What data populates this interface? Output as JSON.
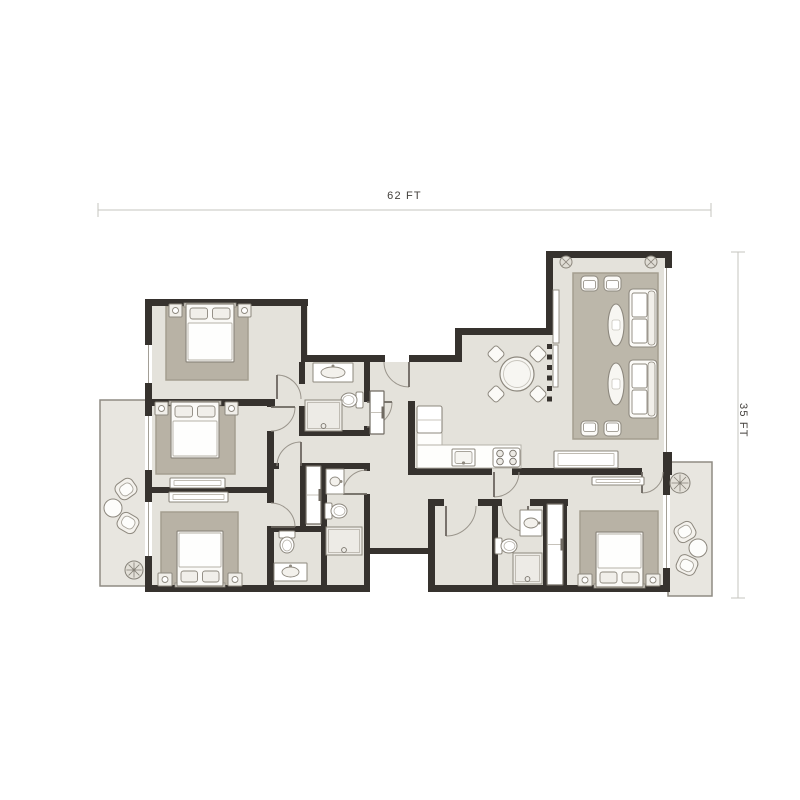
{
  "dimensions": {
    "width_label": "62 FT",
    "height_label": "35 FT",
    "top_line": {
      "x1": 98,
      "x2": 711,
      "y": 210
    },
    "right_line": {
      "x": 738,
      "y1": 252,
      "y2": 598
    }
  },
  "colors": {
    "wall": "#36322e",
    "floor": "#e4e2db",
    "balcony": "#e8e6e0",
    "balconyEdge": "#8f8b83",
    "rug": "#b8b2a5",
    "rugBorder": "#a49e90",
    "livingRug": "#bcb7aa",
    "line": "#8d887e",
    "furn": "#fbfaf7",
    "furnLight": "#f1efea",
    "white": "#ffffff",
    "shower": "#edebe6",
    "innerLine": "#b5b1a8",
    "windowLine": "#a39f96",
    "dimLine": "#c6c4bf",
    "arc": "#9a958c",
    "leaf": "#6b665f",
    "lightGray": "#dcd9d1",
    "dark": "#6f6a62"
  },
  "plan": {
    "balconies": [
      {
        "name": "balcony-left",
        "r": [
          100,
          400,
          48,
          186
        ]
      },
      {
        "name": "balcony-right",
        "r": [
          668,
          462,
          44,
          134
        ]
      }
    ],
    "floors": [
      {
        "name": "floor-bedrooms-left",
        "r": [
          148,
          302,
          160,
          283
        ]
      },
      {
        "name": "floor-corridor",
        "r": [
          305,
          362,
          123,
          192
        ]
      },
      {
        "name": "floor-bath-south",
        "r": [
          308,
          554,
          60,
          32
        ]
      },
      {
        "name": "floor-central",
        "r": [
          462,
          335,
          91,
          140
        ]
      },
      {
        "name": "floor-kitchen-dining",
        "r": [
          410,
          362,
          143,
          113
        ]
      },
      {
        "name": "floor-living-room",
        "r": [
          550,
          255,
          118,
          215
        ]
      },
      {
        "name": "floor-south-cluster",
        "r": [
          368,
          470,
          200,
          84
        ]
      },
      {
        "name": "floor-south-cluster-low",
        "r": [
          428,
          554,
          140,
          32
        ]
      },
      {
        "name": "floor-bedroom-4",
        "r": [
          560,
          470,
          108,
          116
        ]
      }
    ],
    "rugs": [
      {
        "name": "rug-bedroom-1",
        "r": [
          166,
          306,
          82,
          74
        ],
        "living": false
      },
      {
        "name": "rug-bedroom-2",
        "r": [
          156,
          406,
          79,
          68
        ],
        "living": false
      },
      {
        "name": "rug-bedroom-3",
        "r": [
          161,
          512,
          77,
          74
        ],
        "living": false
      },
      {
        "name": "rug-bedroom-4",
        "r": [
          580,
          511,
          78,
          76
        ],
        "living": false
      },
      {
        "name": "rug-living-room",
        "r": [
          573,
          273,
          85,
          166
        ],
        "living": true
      }
    ],
    "walls": [
      [
        145,
        299,
        163,
        7
      ],
      [
        301,
        355,
        84,
        7
      ],
      [
        409,
        355,
        53,
        7
      ],
      [
        455,
        328,
        98,
        7
      ],
      [
        546,
        251,
        126,
        7
      ],
      [
        145,
        399,
        130,
        7
      ],
      [
        145,
        487,
        129,
        6
      ],
      [
        145,
        585,
        225,
        7
      ],
      [
        299,
        430,
        71,
        6
      ],
      [
        267,
        463,
        12,
        6
      ],
      [
        301,
        463,
        69,
        6
      ],
      [
        267,
        526,
        59,
        6
      ],
      [
        368,
        548,
        67,
        6
      ],
      [
        428,
        499,
        16,
        7
      ],
      [
        478,
        499,
        24,
        7
      ],
      [
        530,
        499,
        38,
        7
      ],
      [
        408,
        468,
        84,
        7
      ],
      [
        512,
        468,
        130,
        7
      ],
      [
        663,
        468,
        9,
        7
      ],
      [
        560,
        585,
        110,
        7
      ],
      [
        428,
        585,
        139,
        7
      ],
      [
        145,
        299,
        7,
        46
      ],
      [
        145,
        383,
        7,
        24
      ],
      [
        145,
        406,
        7,
        10
      ],
      [
        145,
        470,
        7,
        32
      ],
      [
        145,
        556,
        7,
        36
      ],
      [
        301,
        299,
        6,
        63
      ],
      [
        455,
        328,
        7,
        34
      ],
      [
        546,
        251,
        7,
        84
      ],
      [
        665,
        251,
        7,
        17
      ],
      [
        663,
        452,
        9,
        23
      ],
      [
        408,
        401,
        7,
        74
      ],
      [
        299,
        362,
        6,
        22
      ],
      [
        299,
        406,
        6,
        30
      ],
      [
        364,
        355,
        6,
        47
      ],
      [
        364,
        426,
        6,
        10
      ],
      [
        267,
        399,
        7,
        8
      ],
      [
        267,
        431,
        7,
        56
      ],
      [
        267,
        487,
        7,
        16
      ],
      [
        267,
        527,
        7,
        65
      ],
      [
        300,
        463,
        6,
        63
      ],
      [
        321,
        463,
        6,
        122
      ],
      [
        364,
        463,
        6,
        8
      ],
      [
        364,
        494,
        6,
        96
      ],
      [
        428,
        499,
        7,
        93
      ],
      [
        492,
        499,
        6,
        93
      ],
      [
        543,
        499,
        4,
        90
      ],
      [
        563,
        499,
        4,
        90
      ],
      [
        663,
        475,
        7,
        20
      ],
      [
        663,
        568,
        7,
        24
      ]
    ],
    "windows": [
      [
        145,
        345,
        7,
        38
      ],
      [
        145,
        416,
        7,
        54
      ],
      [
        145,
        502,
        7,
        54
      ],
      [
        663,
        495,
        7,
        73
      ],
      [
        664,
        268,
        5,
        184
      ]
    ],
    "doors": [
      {
        "leaf": "M409 362 L409 387",
        "arc": "M409 387 A25 25 0 0 1 384 362"
      },
      {
        "leaf": "M367 402 L392 402",
        "arc": "M392 402 A25 25 0 0 1 367 427"
      },
      {
        "leaf": "M271 407 L295 407",
        "arc": "M295 407 A24 24 0 0 1 271 431"
      },
      {
        "leaf": "M271 527 L295 527",
        "arc": "M295 527 A24 24 0 0 0 271 503"
      },
      {
        "leaf": "M301 466 L301 442",
        "arc": "M301 442 A24 24 0 0 0 277 466"
      },
      {
        "leaf": "M494 472 L494 497",
        "arc": "M494 497 A25 25 0 0 0 519 472"
      },
      {
        "leaf": "M446 506 L446 536",
        "arc": "M446 536 A30 30 0 0 0 476 506"
      },
      {
        "leaf": "M528 506 L528 532",
        "arc": "M528 532 A26 26 0 0 1 502 506"
      },
      {
        "leaf": "M642 472 L642 493",
        "arc": "M642 493 A21 21 0 0 0 663 472"
      },
      {
        "leaf": "M367 494 L343 494",
        "arc": "M343 494 A24 24 0 0 1 367 470"
      },
      {
        "leaf": "M277 399 L277 375",
        "arc": "M277 375 A24 24 0 0 1 301 399"
      }
    ],
    "dash_partition": {
      "x": 547,
      "y0": 344,
      "count": 6,
      "size": 5,
      "gap": 5.5
    },
    "wall_shelves": [
      {
        "name": "tv-console",
        "r": [
          553,
          290,
          6,
          53
        ]
      },
      {
        "name": "wall-shelf",
        "r": [
          553,
          345,
          5,
          42
        ]
      }
    ],
    "beds": [
      {
        "name": "bed-bedroom-1",
        "x": 186,
        "y": 304,
        "w": 48,
        "h": 58,
        "head": "top"
      },
      {
        "name": "bed-bedroom-2",
        "x": 171,
        "y": 402,
        "w": 48,
        "h": 56,
        "head": "top"
      },
      {
        "name": "bed-bedroom-3",
        "x": 177,
        "y": 531,
        "w": 46,
        "h": 55,
        "head": "bottom"
      },
      {
        "name": "bed-bedroom-4",
        "x": 596,
        "y": 532,
        "w": 47,
        "h": 55,
        "head": "bottom"
      }
    ],
    "nightstands": [
      [
        169,
        304,
        13,
        13
      ],
      [
        238,
        304,
        13,
        13
      ],
      [
        155,
        402,
        13,
        13
      ],
      [
        225,
        402,
        13,
        13
      ],
      [
        158,
        573,
        14,
        13
      ],
      [
        228,
        573,
        14,
        13
      ],
      [
        578,
        574,
        14,
        12
      ],
      [
        646,
        574,
        14,
        12
      ]
    ],
    "dressers": [
      {
        "name": "dresser-bedroom-2",
        "r": [
          170,
          478,
          55,
          10
        ]
      },
      {
        "name": "dresser-bedroom-3",
        "r": [
          169,
          492,
          59,
          10
        ]
      },
      {
        "name": "console-bedroom-4",
        "r": [
          592,
          477,
          52,
          8
        ]
      },
      {
        "name": "sideboard-living",
        "r": [
          554,
          451,
          64,
          17
        ]
      }
    ],
    "wardrobes": [
      {
        "name": "wardrobe-corridor",
        "r": [
          370,
          391,
          14,
          43
        ]
      },
      {
        "name": "wardrobe-cluster",
        "r": [
          306,
          466,
          15,
          58
        ]
      },
      {
        "name": "closet-bedroom-4",
        "r": [
          547,
          504,
          16,
          81
        ]
      }
    ],
    "sofas": [
      {
        "name": "sofa-1",
        "r": [
          629,
          289,
          28,
          58
        ]
      },
      {
        "name": "sofa-2",
        "r": [
          629,
          360,
          28,
          58
        ]
      }
    ],
    "armchairs": [
      {
        "r": [
          581,
          276,
          17,
          15
        ],
        "face": "down"
      },
      {
        "r": [
          604,
          276,
          17,
          15
        ],
        "face": "down"
      },
      {
        "r": [
          581,
          421,
          17,
          15
        ],
        "face": "up"
      },
      {
        "r": [
          604,
          421,
          17,
          15
        ],
        "face": "up"
      }
    ],
    "oval_tables": [
      [
        616,
        325,
        8,
        21
      ],
      [
        616,
        384,
        8,
        21
      ]
    ],
    "ceiling_lights": [
      [
        566,
        262,
        6
      ],
      [
        651,
        262,
        6
      ]
    ],
    "dining": {
      "table": [
        517,
        374,
        17
      ],
      "chair_size": 13,
      "chairs": [
        [
          496,
          354
        ],
        [
          538,
          354
        ],
        [
          496,
          394
        ],
        [
          538,
          394
        ]
      ]
    },
    "kitchen": {
      "fridge": [
        417,
        406,
        25,
        27
      ],
      "counters": [
        [
          417,
          433,
          25,
          35
        ],
        [
          417,
          445,
          104,
          23
        ]
      ],
      "sink": [
        452,
        449,
        23,
        17
      ],
      "hob": [
        493,
        448,
        27,
        19
      ]
    },
    "vanities": [
      {
        "name": "vanity-bath-north",
        "r": [
          313,
          363,
          40,
          19
        ],
        "o": "h"
      },
      {
        "name": "vanity-bath-mid",
        "r": [
          326,
          469,
          18,
          25
        ],
        "o": "v"
      },
      {
        "name": "vanity-bath-maid",
        "r": [
          274,
          563,
          33,
          18
        ],
        "o": "h"
      },
      {
        "name": "vanity-bath-south",
        "r": [
          520,
          510,
          22,
          26
        ],
        "o": "v"
      }
    ],
    "toilets": [
      {
        "name": "toilet-bath-north",
        "c": [
          352,
          400
        ],
        "rot": -90
      },
      {
        "name": "toilet-bath-mid",
        "c": [
          336,
          511
        ],
        "rot": 90
      },
      {
        "name": "toilet-bath-maid",
        "c": [
          287,
          542
        ],
        "rot": 180
      },
      {
        "name": "toilet-bath-south",
        "c": [
          506,
          546
        ],
        "rot": 90
      }
    ],
    "showers": [
      {
        "name": "shower-bath-north",
        "r": [
          305,
          400,
          37,
          31
        ]
      },
      {
        "name": "shower-bath-mid",
        "r": [
          326,
          527,
          36,
          28
        ]
      },
      {
        "name": "shower-bath-south",
        "r": [
          513,
          553,
          29,
          31
        ]
      }
    ],
    "balcony_chairs": [
      {
        "c": [
          126,
          489
        ],
        "rot": -35
      },
      {
        "c": [
          128,
          523
        ],
        "rot": 210
      },
      {
        "c": [
          685,
          532
        ],
        "rot": 150
      },
      {
        "c": [
          687,
          565
        ],
        "rot": 25
      }
    ],
    "balcony_tables": [
      [
        113,
        508,
        9
      ],
      [
        698,
        548,
        9
      ]
    ],
    "plants": [
      [
        134,
        570,
        9
      ],
      [
        680,
        483,
        10
      ]
    ]
  }
}
